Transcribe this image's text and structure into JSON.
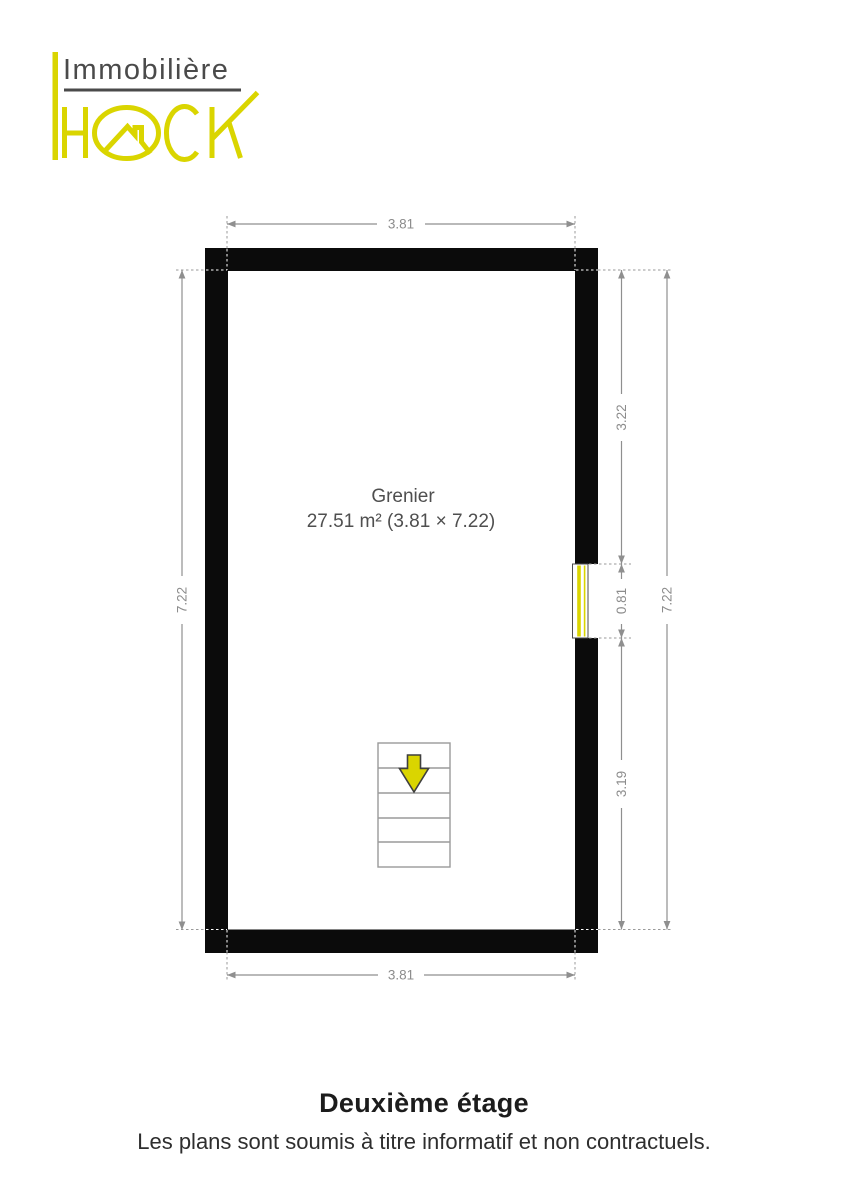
{
  "brand": {
    "name_top": "Immobilière",
    "name_bottom": "HACK",
    "accent_color": "#dad500",
    "text_color": "#4a4a4a"
  },
  "plan": {
    "room": {
      "name": "Grenier",
      "area_label": "27.51 m² (3.81 × 7.22)"
    },
    "dimensions": {
      "top_width": "3.81",
      "bottom_width": "3.81",
      "left_height": "7.22",
      "right_total_height": "7.22",
      "right_upper_segment": "3.22",
      "window_height": "0.81",
      "right_lower_segment": "3.19"
    },
    "colors": {
      "wall": "#0b0b0b",
      "dimension_line": "#8f8f8f",
      "window_accent": "#dad500",
      "stair_arrow_fill": "#dad500"
    }
  },
  "footer": {
    "title": "Deuxième étage",
    "disclaimer": "Les plans sont soumis à titre informatif et non contractuels."
  }
}
